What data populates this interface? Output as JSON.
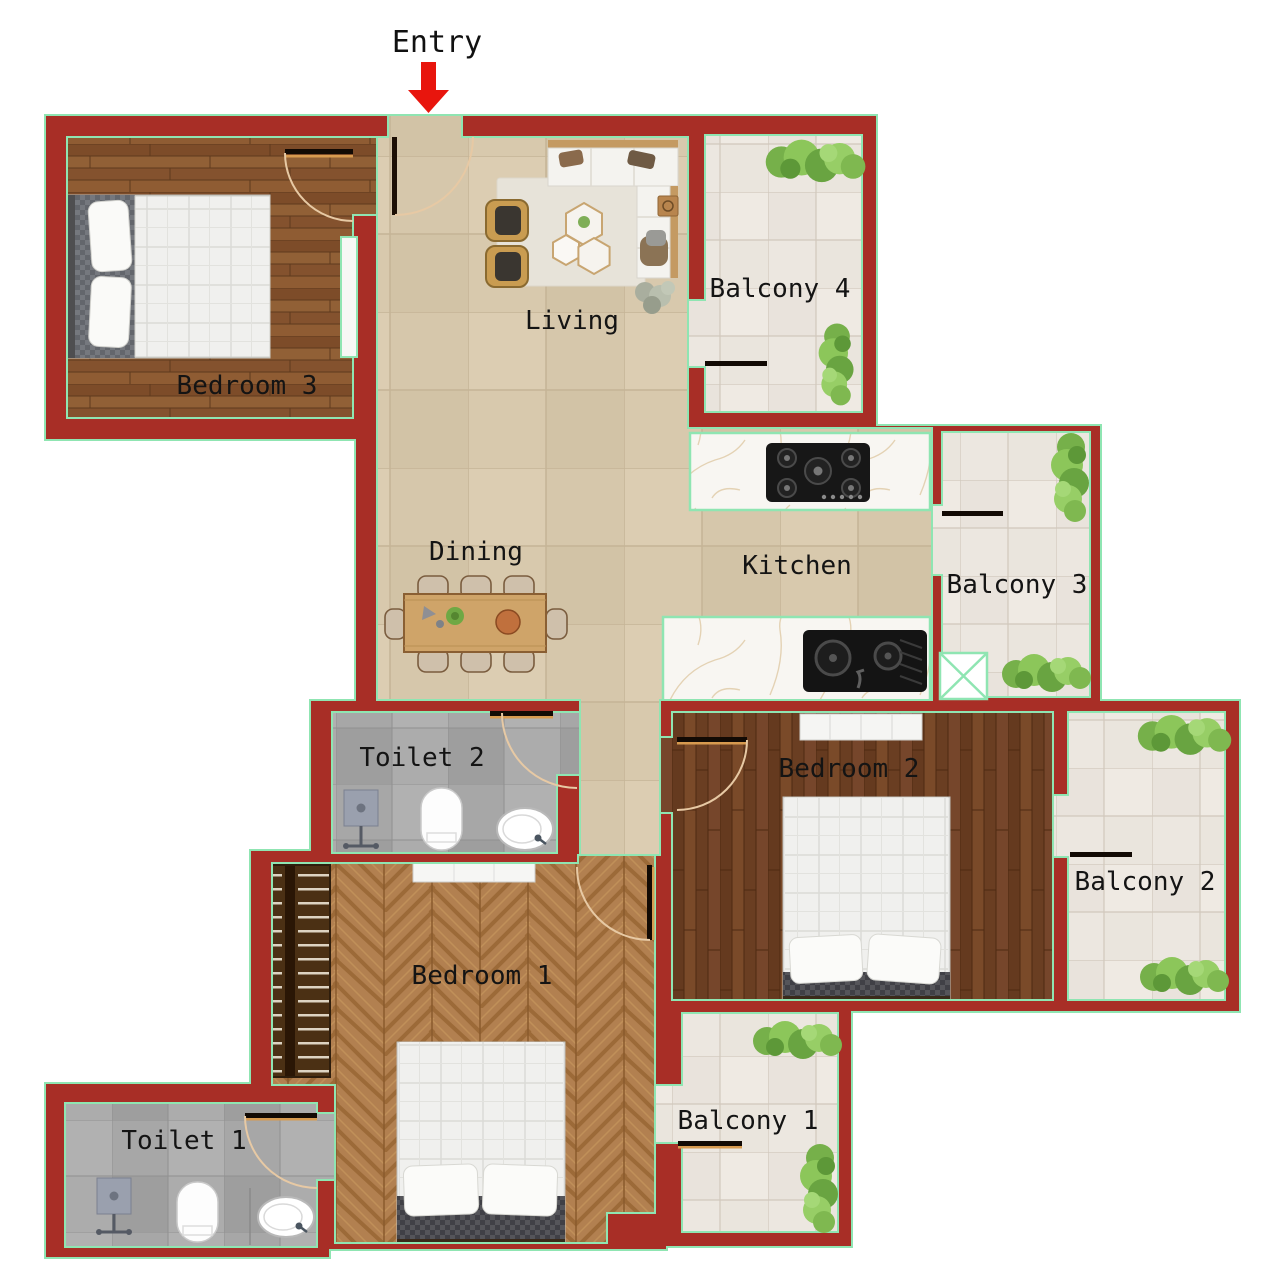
{
  "title": "Apartment floor plan",
  "entry": {
    "label": "Entry"
  },
  "rooms": {
    "bedroom3": {
      "label": "Bedroom 3"
    },
    "living": {
      "label": "Living"
    },
    "balcony4": {
      "label": "Balcony 4"
    },
    "kitchen": {
      "label": "Kitchen"
    },
    "balcony3": {
      "label": "Balcony 3"
    },
    "dining": {
      "label": "Dining"
    },
    "toilet2": {
      "label": "Toilet 2"
    },
    "bedroom2": {
      "label": "Bedroom 2"
    },
    "balcony2": {
      "label": "Balcony 2"
    },
    "bedroom1": {
      "label": "Bedroom 1"
    },
    "toilet1": {
      "label": "Toilet 1"
    },
    "balcony1": {
      "label": "Balcony 1"
    }
  },
  "colors": {
    "wall": "#a82e26",
    "wall_outline": "#8fe5b2",
    "entry_arrow": "#e8150d",
    "label_text": "#141414",
    "floor_beige": "#d8c9ad",
    "wood_bedroom3": "#8a5733",
    "wood_bedroom2": "#6f4124",
    "wood_bedroom1": "#b28050",
    "tile_balcony": "#ece7e0",
    "tile_toilet": "#a7a7a7",
    "counter_marble": "#f8f6f2",
    "door_arc": "#e7c9a4",
    "plant_green": "#8cc65a"
  }
}
